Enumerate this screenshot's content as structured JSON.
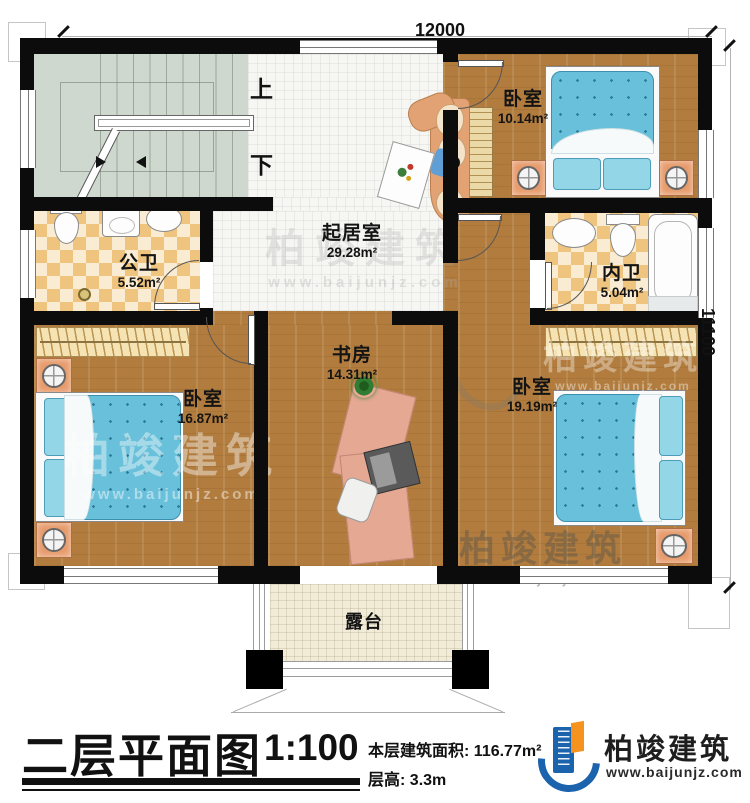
{
  "dimensions": {
    "width_mm": "12000",
    "height_mm": "11100"
  },
  "stairs": {
    "up": "上",
    "down": "下"
  },
  "rooms": {
    "living": {
      "name": "起居室",
      "area": "29.28m²"
    },
    "bedroom_top": {
      "name": "卧室",
      "area": "10.14m²"
    },
    "bath_inner": {
      "name": "内卫",
      "area": "5.04m²"
    },
    "bedroom_right": {
      "name": "卧室",
      "area": "19.19m²"
    },
    "study": {
      "name": "书房",
      "area": "14.31m²"
    },
    "bedroom_left": {
      "name": "卧室",
      "area": "16.87m²"
    },
    "bath_public": {
      "name": "公卫",
      "area": "5.52m²"
    },
    "terrace": {
      "name": "露台"
    }
  },
  "titleblock": {
    "title": "二层平面图",
    "scale": "1:100",
    "floor_area_label": "本层建筑面积:",
    "floor_area_value": "116.77m²",
    "floor_height_label": "层高:",
    "floor_height_value": "3.3m"
  },
  "brand": {
    "name": "柏竣建筑",
    "website": "www.baijunjz.com"
  },
  "colors": {
    "wall": "#0c0c0c",
    "wood": "#b17c3e",
    "tile": "#f6f6f3",
    "checker_dark": "#eec47f",
    "checker_light": "#f9ecd2",
    "stair": "#cfd8ce",
    "bed_blue": "#68c0da",
    "accent_blue": "#1c63ad",
    "accent_orange": "#f6921e",
    "terrace": "#f1ebd8"
  }
}
